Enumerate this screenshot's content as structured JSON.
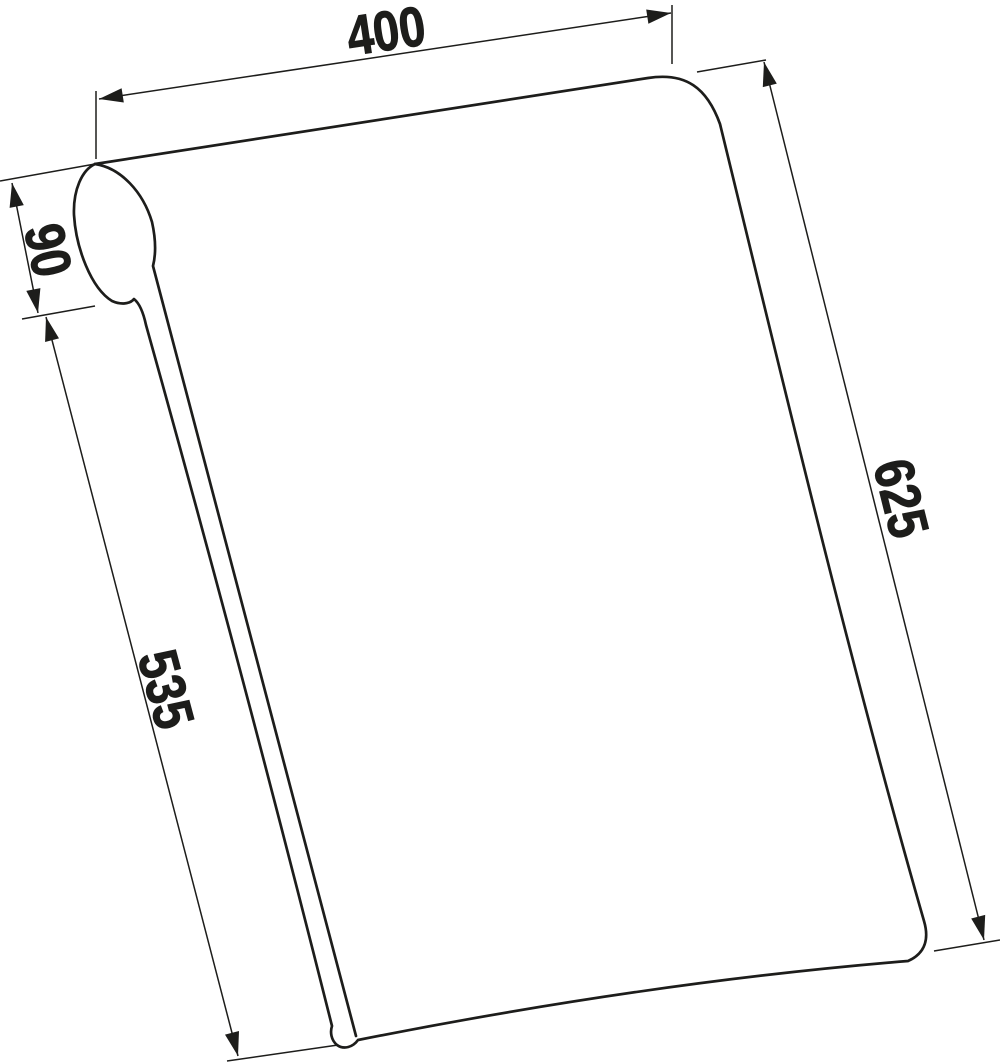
{
  "drawing": {
    "object": "panel-with-rolled-front-edge",
    "view": "oblique-technical-drawing",
    "background": "#ffffff",
    "line_color": "#1d1d1b",
    "text_color": "#1d1d1b",
    "dimensions": {
      "top_width": "400",
      "roll_depth": "90",
      "front_edge_length": "535",
      "side_edge_length": "625"
    }
  }
}
